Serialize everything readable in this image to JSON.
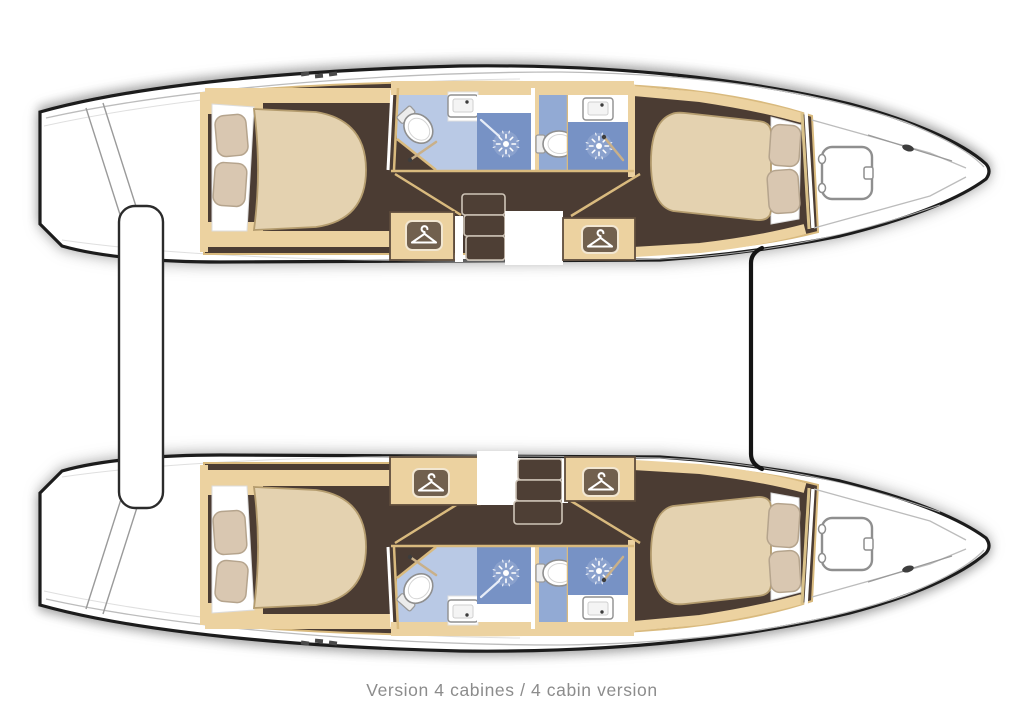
{
  "caption": "Version 4 cabines / 4 cabin version",
  "plan": {
    "vessel": "catamaran interior deck plan, bow pointing right",
    "layout_name": "4 cabin version",
    "hulls": [
      {
        "name": "upper hull",
        "rooms": [
          "aft double cabin",
          "aft bathroom with shower",
          "forward bathroom with shower",
          "wardrobe",
          "companionway steps",
          "wardrobe",
          "forward double cabin",
          "bow locker with deck hatch"
        ]
      },
      {
        "name": "lower hull",
        "rooms": [
          "aft double cabin",
          "aft bathroom with shower",
          "forward bathroom with shower",
          "wardrobe",
          "companionway steps",
          "wardrobe",
          "forward double cabin",
          "bow locker with deck hatch"
        ]
      }
    ],
    "features": [
      "aft crossbeam",
      "forward crossbeam",
      "transom steps",
      "deck cleats"
    ]
  },
  "icons": {
    "hanger": "hanger-icon",
    "shower": "shower-head-icon",
    "toilet": "toilet-icon",
    "sink": "sink-icon",
    "hatch": "deck-hatch-icon",
    "cleat": "cleat-icon"
  },
  "colors": {
    "floor-brown": "#4b3c33",
    "wood-tan": "#ecd2a0",
    "wood-line": "#d9ba7e",
    "wood-edge": "#5f4d3c",
    "mattress": "#e4d2b0",
    "mattress-line": "#b49c6e",
    "pillow": "#d9c7b1",
    "pillow-line": "#b5a48d",
    "sheet": "#ffffff",
    "bath-light": "#b9c9e5",
    "bath-mid": "#92aad4",
    "shower-blue": "#7792c5",
    "fixture-line": "#8f8f8f",
    "steps": "#4e3f35",
    "steps-line": "#cfc5b8",
    "hanger-plate": "#71604e",
    "hanger-plate-edge": "#f2e7d2",
    "hanger-glyph": "#ffffff",
    "hull-line": "#1c1c1c",
    "deck-line": "#bcbcbc",
    "rod-tan": "#c9b089",
    "metal-dark": "#3d3d3d",
    "caption": "#8c8c8c",
    "bg": "#ffffff"
  }
}
